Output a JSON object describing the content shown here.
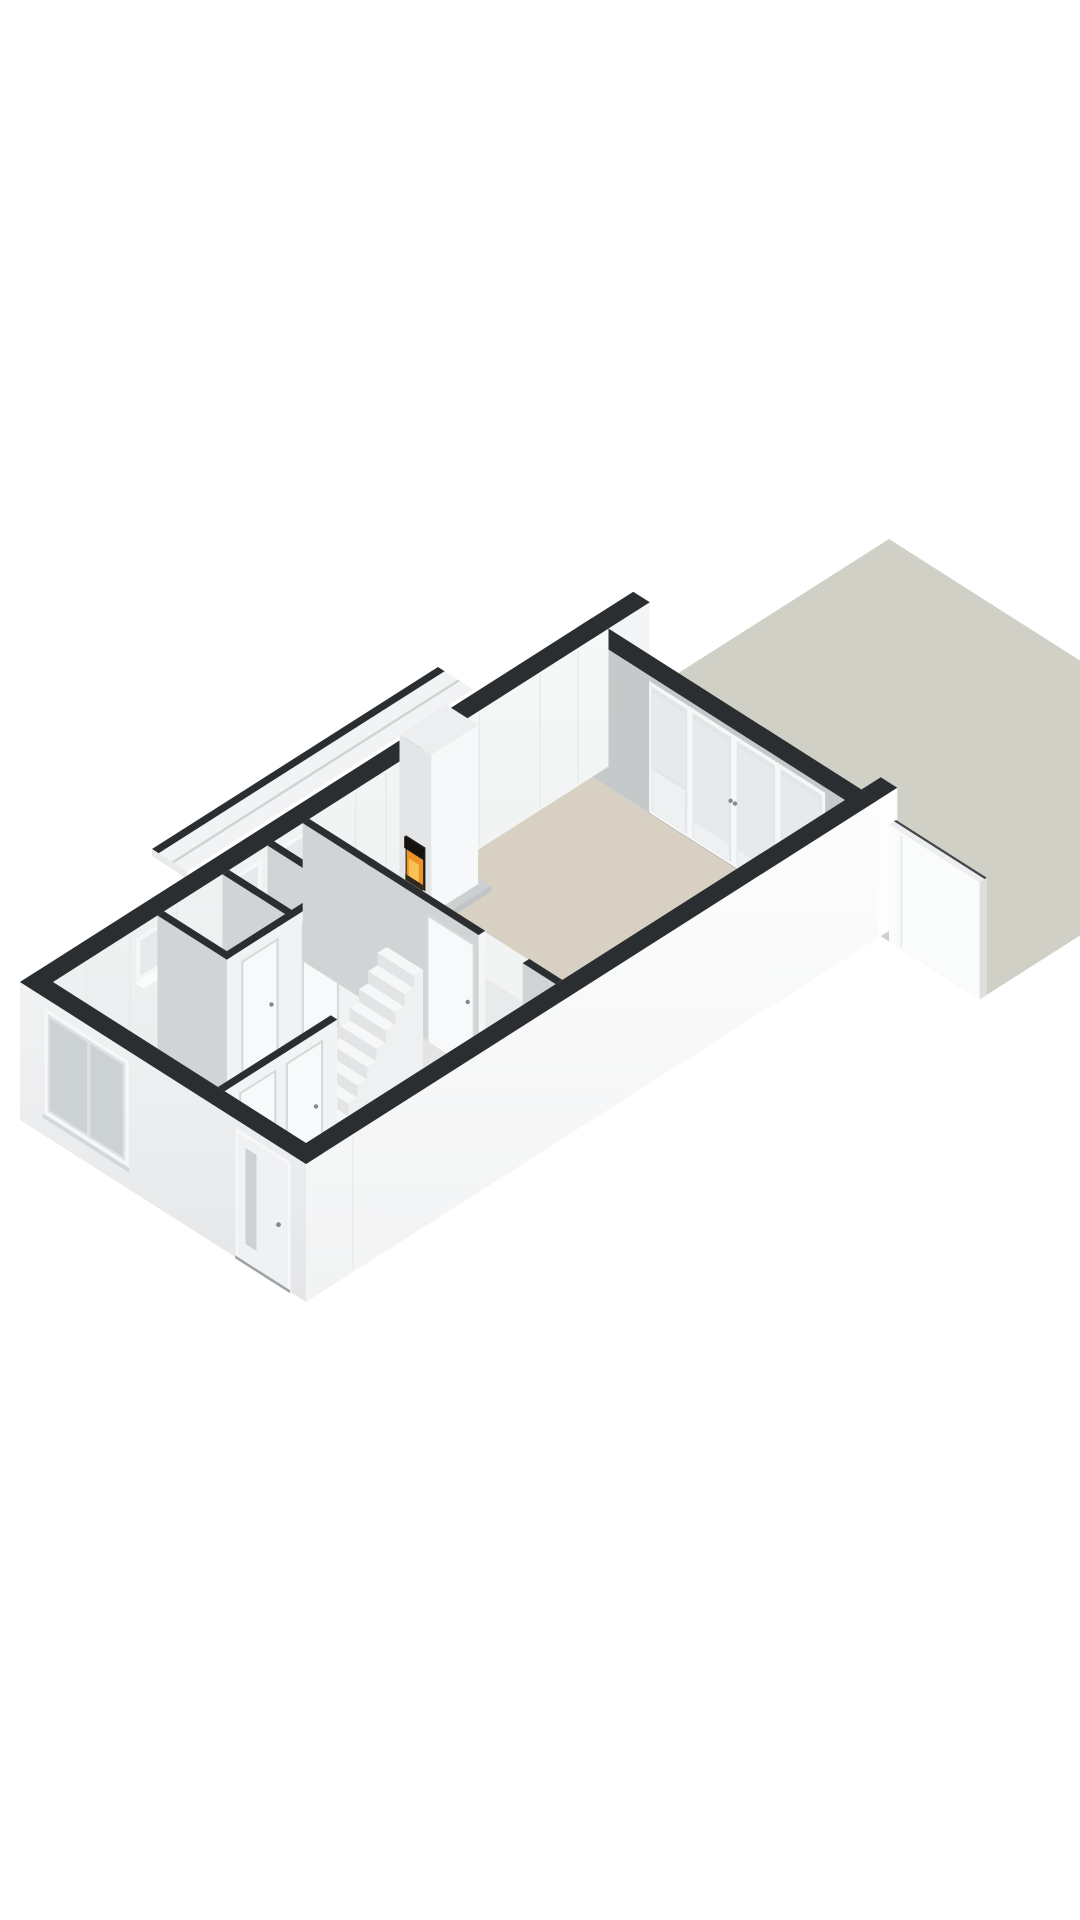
{
  "page": {
    "title": "3D floor plan render – ground floor with garden",
    "background": "#ffffff"
  },
  "view": {
    "width": 1080,
    "height": 1920
  },
  "projection": {
    "ax": 55,
    "by": 35,
    "hz": 60,
    "ox": 20,
    "oy": 1120
  },
  "palette": {
    "background": "#ffffff",
    "wall_top": "#2b2e31",
    "wall_top_soft": "#43474a",
    "wall_inner_white_hi": "#f7f9f9",
    "wall_inner_white_lo": "#e9ebec",
    "wall_inner_gray": "#c6c9ca",
    "wall_interior_gray": "#d1d4d5",
    "wall_outer_white_hi": "#fdfdfd",
    "wall_outer_white_lo": "#f2f3f4",
    "wall_outer_front": "#ebedee",
    "wall_end": "#dcdee0",
    "floor_living": "#d8d1c3",
    "floor_hall": "#e4e4e2",
    "garden": "#d1d0c7",
    "frame_white": "#f6f7f8",
    "frame_inner": "#e3e6e7",
    "panel_white": "#eef0f1",
    "glass": "#e7eaec",
    "glass_dark": "#ccd1d4",
    "threshold": "#9ea3a5",
    "door_leaf": "#f8f9fa",
    "door_frame": "#d7dadb",
    "handle": "#83898d",
    "seam": "#e7e9ea",
    "roofstrip_top": "#f2f3f4",
    "roofstrip_seam": "#cfd2d3",
    "stair_tread": "#f6f7f8",
    "stair_riser": "#e2e4e5",
    "stair_side": "#eef0f1",
    "fence_face": "#fafbfb",
    "fence_top": "#eceeef",
    "plinth_top": "#cdd0d1",
    "plinth_front": "#b9bcbe",
    "plinth_side": "#c2c5c7",
    "breast_front": "#e3e5e6",
    "breast_side": "#f7f8f9",
    "breast_top": "#eceeef",
    "firebox": "#211d19",
    "fire_flame": "#ee9426",
    "fire_core": "#f9c257",
    "fire_log": "#33261a",
    "fire_hood": "#15120f",
    "counter_top": "#f2f3f3",
    "counter_front": "#e8eaeb",
    "counter_side": "#dcdee0",
    "sink_rim": "#989ea1",
    "sink_fill": "#edeff0",
    "sink_inner": "#b6bbbd"
  },
  "scene": {
    "wall_height": 2.3,
    "house": {
      "length": 10.4,
      "width": 5.2,
      "ext": 0.3
    },
    "garden": {
      "u0": 10.45,
      "u1": 16.2,
      "v0": -0.4,
      "v1": 7.0
    },
    "fence": {
      "u": 10.45,
      "thick": 0.13,
      "v0": 5.35,
      "v1": 7.0,
      "h": 1.95,
      "gate_v": 5.58
    },
    "stub_left": {
      "u0": 10.4,
      "u1": 11.15,
      "v0": 0,
      "v1": 0.3
    },
    "stub_right": {
      "u0": 10.4,
      "u1": 10.75,
      "v0": 4.9,
      "v1": 5.2
    },
    "rear_wall": {
      "u0": 10.1,
      "u1": 10.4
    },
    "rear_glazing": {
      "v0": 1.35,
      "units": [
        {
          "t": "window",
          "w": 0.75
        },
        {
          "t": "door",
          "w": 0.8
        },
        {
          "t": "door",
          "w": 0.8
        },
        {
          "t": "window",
          "w": 0.85
        }
      ]
    },
    "roof_strip": {
      "u0": 3.1,
      "u1": 8.3,
      "v0": -0.7,
      "v1": -0.06
    },
    "floors": {
      "living_u0": 4.96,
      "hall_u0": 0.3,
      "inner_v0": 0.3,
      "inner_v1": 4.9
    },
    "left_windows": [
      {
        "u0": 1.85,
        "u1": 2.35
      },
      {
        "u0": 3.55,
        "u1": 4.05
      },
      {
        "u0": 4.45,
        "u1": 4.95
      }
    ],
    "wall_seams_u": [
      0.9,
      1.7,
      2.55,
      5.8,
      6.35,
      8.05,
      9.15,
      9.85
    ],
    "closet_cross_walls_u": [
      4.2,
      3.38,
      2.2
    ],
    "closet_wall": {
      "v": 1.44,
      "thick": 0.12,
      "u0": 2.2,
      "u1": 4.96,
      "doors": [
        {
          "u0": 2.5,
          "u1": 3.1
        },
        {
          "u0": 3.6,
          "u1": 4.2
        }
      ]
    },
    "hall_wall": {
      "v": 3.3,
      "thick": 0.12,
      "u0": 0.3,
      "u1": 2.35,
      "doors": [
        {
          "u0": 0.6,
          "u1": 1.2
        },
        {
          "u0": 1.45,
          "u1": 2.05
        }
      ]
    },
    "living_wall": {
      "u": 4.84,
      "thick": 0.12,
      "segA": [
        0.3,
        3.5
      ],
      "segB": [
        4.3,
        4.9
      ],
      "door": {
        "v0": 2.6,
        "v1": 3.4
      }
    },
    "stairs": {
      "u0": 2.35,
      "steps": 10,
      "tread": 0.17,
      "rise": 0.205,
      "v0": 2.62,
      "v1": 3.28
    },
    "fireplace": {
      "u0": 6.6,
      "u1": 7.45,
      "v0": 0.3,
      "v1": 0.88,
      "h": 2.75,
      "plinth": {
        "u0": 6.5,
        "u1": 7.55,
        "v1": 1.02,
        "h": 0.1
      },
      "firebox": {
        "v0": 0.42,
        "v1": 0.78,
        "z0": 0.42,
        "z1": 1.15
      }
    },
    "island": {
      "A": {
        "u0": 5.45,
        "u1": 6.1,
        "v0": 1.8,
        "v1": 3.7,
        "h": 0.95
      },
      "B": {
        "u0": 4.96,
        "u1": 5.45,
        "v0": 3.05,
        "v1": 3.7,
        "h": 0.95
      },
      "sink": {
        "u0": 5.55,
        "u1": 6.0,
        "v0": 2.0,
        "v1": 2.6
      },
      "faucet": {
        "u": 5.57,
        "v": 2.06
      }
    },
    "front_window": {
      "v0": 0.5,
      "v1": 1.95,
      "z0": 0.45,
      "z1": 2.08,
      "mullion": [
        1.24,
        1.3
      ]
    },
    "front_door": {
      "v0": 3.98,
      "v1": 4.88,
      "h": 2.12,
      "glass_v0": 4.12,
      "glass_v1": 4.32,
      "handle_v": 4.72,
      "handle_z": 1.02
    }
  }
}
